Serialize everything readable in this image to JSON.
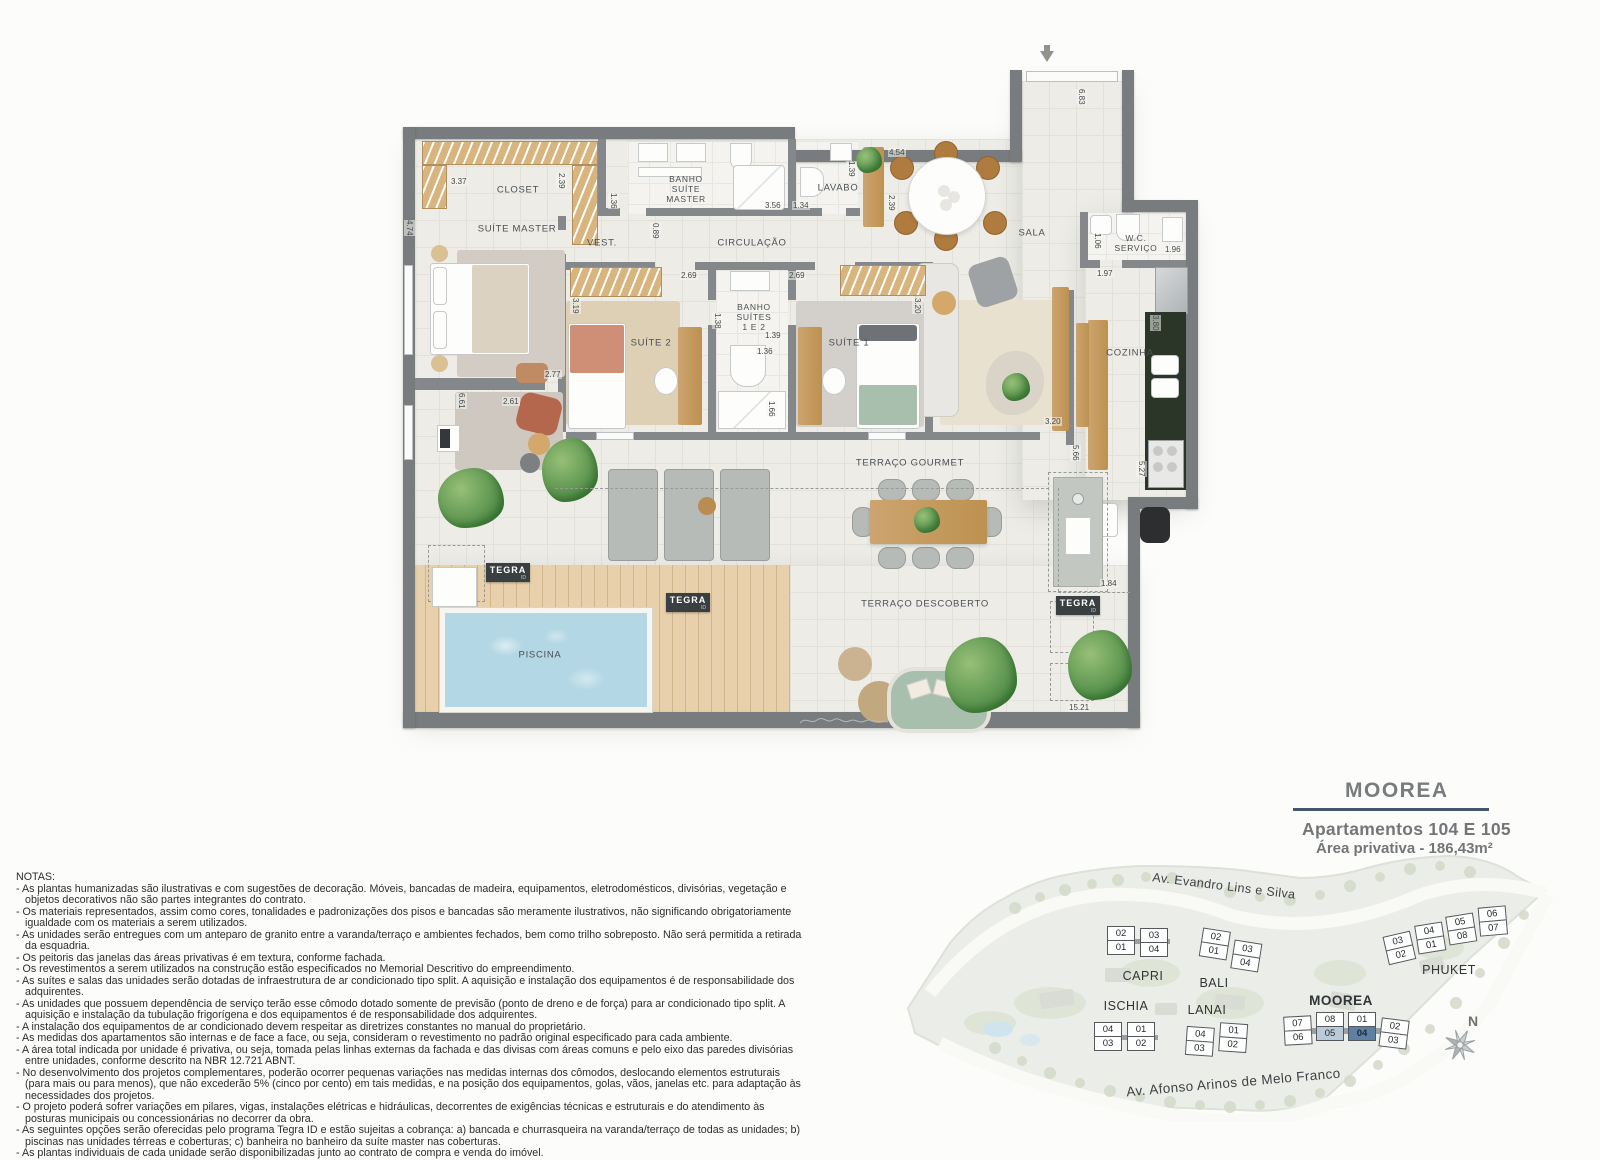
{
  "colors": {
    "wall": "#787c7f",
    "tile_floor": "#edece7",
    "deck_wood": "#e7d0ab",
    "pool_water": "#b3d7e4",
    "accent_line": "#41586e",
    "highlight_unit_105": "#b9cbd9",
    "highlight_unit_104": "#5e80a5",
    "tegra_badge": "#3a3f41"
  },
  "plan": {
    "rooms": [
      {
        "label": "CLOSET"
      },
      {
        "label": "SUÍTE MASTER"
      },
      {
        "label": "BANHO\nSUÍTE\nMASTER"
      },
      {
        "label": "VEST."
      },
      {
        "label": "CIRCULAÇÃO"
      },
      {
        "label": "LAVABO"
      },
      {
        "label": "SALA"
      },
      {
        "label": "SUÍTE 2"
      },
      {
        "label": "BANHO\nSUÍTES\n1 E 2"
      },
      {
        "label": "SUÍTE 1"
      },
      {
        "label": "W.C.\nSERVIÇO"
      },
      {
        "label": "COZINHA"
      },
      {
        "label": "TERRAÇO GOURMET"
      },
      {
        "label": "TERRAÇO DESCOBERTO"
      },
      {
        "label": "PISCINA"
      }
    ],
    "dimensions": [
      "3.37",
      "2.39",
      "4.74",
      "1.36",
      "3.56",
      "0.89",
      "1.34",
      "1.39",
      "4.54",
      "2.39",
      "6.83",
      "2.69",
      "2.69",
      "3.19",
      "3.20",
      "1.38",
      "1.39",
      "1.36",
      "1.66",
      "2.77",
      "6.61",
      "2.61",
      "1.06",
      "1.96",
      "1.97",
      "3.80",
      "3.20",
      "5.66",
      "5.27",
      "1.84",
      "15.21"
    ],
    "badges": {
      "tegra": "TEGRA",
      "tegra_sub": "ID"
    }
  },
  "title_block": {
    "project": "MOOREA",
    "line1": "Apartamentos 104 E 105",
    "line2": "Área privativa - 186,43m²"
  },
  "notes": {
    "heading": "NOTAS:",
    "lines": [
      "- As plantas humanizadas são ilustrativas e com sugestões de decoração. Móveis, bancadas de madeira, equipamentos, eletrodomésticos, divisórias, vegetação e objetos decorativos não são partes integrantes do contrato.",
      "- Os materiais representados, assim como cores, tonalidades e padronizações dos pisos e bancadas são meramente ilustrativos, não significando obrigatoriamente igualdade com os materiais a serem utilizados.",
      "- As unidades serão entregues com um anteparo de granito entre a varanda/terraço e ambientes fechados, bem como trilho sobreposto. Não será permitida a retirada da esquadria.",
      "- Os peitoris das janelas das áreas privativas é em textura, conforme fachada.",
      "- Os revestimentos a serem utilizados na construção estão especificados no Memorial Descritivo do empreendimento.",
      "- As suítes e salas das unidades serão dotadas de infraestrutura de ar condicionado tipo split. A aquisição e instalação dos equipamentos é de responsabilidade dos adquirentes.",
      "- As unidades que possuem dependência de serviço terão esse cômodo dotado somente de previsão (ponto de dreno e de força) para ar condicionado tipo split. A aquisição e instalação da tubulação frigorígena e dos equipamentos é de responsabilidade dos adquirentes.",
      "- A instalação dos equipamentos de ar condicionado devem respeitar as diretrizes constantes no manual do proprietário.",
      "- As medidas dos apartamentos são internas e de face a face, ou seja, consideram o revestimento no padrão original especificado para cada ambiente.",
      "- A área total indicada por unidade é privativa, ou seja, tomada pelas linhas externas da fachada e das divisas com áreas comuns e pelo eixo das paredes divisórias entre unidades, conforme descrito na NBR 12.721 ABNT.",
      "- No desenvolvimento dos projetos complementares, poderão ocorrer pequenas variações nas medidas internas dos cômodos, deslocando elementos estruturais (para mais ou para menos), que não excederão 5% (cinco por cento) em tais medidas, e na posição dos equipamentos, golas, vãos, janelas etc. para adaptação às necessidades dos projetos.",
      "- O projeto poderá sofrer variações em pilares, vigas, instalações elétricas e hidráulicas, decorrentes de exigências técnicas e estruturais e do atendimento às posturas municipais ou concessionárias no decorrer da obra.",
      "- As seguintes opções serão oferecidas pelo programa Tegra ID e estão sujeitas a cobrança: a) bancada e churrasqueira na varanda/terraço de todas as unidades; b) piscinas nas unidades térreas e coberturas; c) banheira no banheiro da suíte master nas coberturas.",
      "- As plantas individuais de cada unidade serão disponibilizadas junto ao contrato de compra e venda do imóvel."
    ]
  },
  "site_plan": {
    "streets": [
      "Av. Evandro Lins e Silva",
      "Av. Afonso  Arinos de Melo Franco"
    ],
    "compass_label": "N",
    "buildings": [
      {
        "name": "CAPRI",
        "cols": [
          [
            "02",
            "01"
          ],
          [
            "03",
            "04"
          ]
        ]
      },
      {
        "name": "BALI",
        "cols": [
          [
            "02",
            "01"
          ],
          [
            "03",
            "04"
          ]
        ]
      },
      {
        "name": "ISCHIA",
        "cols": [
          [
            "04",
            "03"
          ],
          [
            "01",
            "02"
          ]
        ]
      },
      {
        "name": "LANAI",
        "cols": [
          [
            "04",
            "03"
          ],
          [
            "01",
            "02"
          ]
        ]
      },
      {
        "name": "MOOREA",
        "cols": [
          [
            "07",
            "06"
          ],
          [
            "08",
            "05"
          ],
          [
            "01",
            "04"
          ],
          [
            "02",
            "03"
          ]
        ]
      },
      {
        "name": "PHUKET",
        "cols": [
          [
            "03",
            "02"
          ],
          [
            "04",
            "01"
          ],
          [
            "05",
            "08"
          ],
          [
            "06",
            "07"
          ]
        ]
      }
    ],
    "highlight": {
      "light_unit": "05",
      "dark_unit": "04",
      "light_color": "#b9cbd9",
      "dark_color": "#5e80a5"
    }
  }
}
